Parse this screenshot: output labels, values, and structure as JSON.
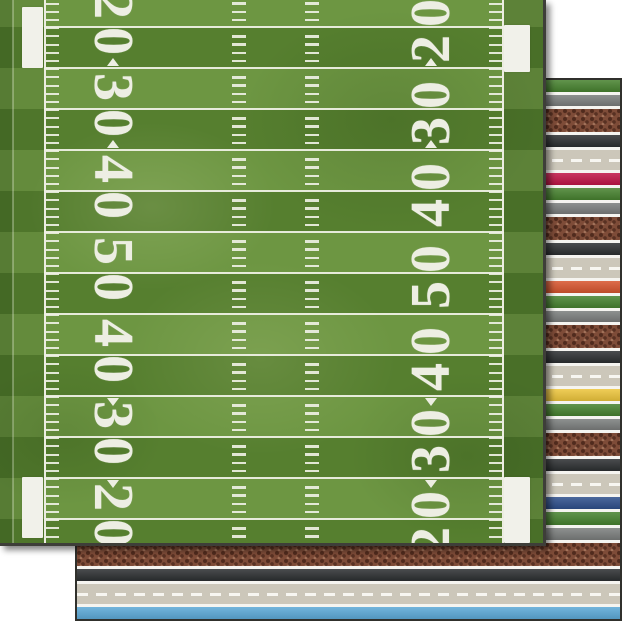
{
  "scene": {
    "background_color": "#ffffff",
    "front_sheet": "football-field",
    "back_sheet": "sport-stripes"
  },
  "field_sheet": {
    "yard_numbers": [
      {
        "value": "20",
        "arrow": "none"
      },
      {
        "value": "30",
        "arrow": "up"
      },
      {
        "value": "40",
        "arrow": "up"
      },
      {
        "value": "50",
        "arrow": "none"
      },
      {
        "value": "40",
        "arrow": "down"
      },
      {
        "value": "30",
        "arrow": "down"
      },
      {
        "value": "20",
        "arrow": "none"
      }
    ],
    "colors": {
      "band_light": "#6d9642",
      "band_dark": "#567f2f",
      "margin_green": "#48702a",
      "line_white": "#ecede1",
      "number_white": "#edeee3",
      "edge_border": "#3e3e39"
    }
  },
  "stripe_sheet": {
    "palette": {
      "green": "#47822f",
      "gray": "#7b7e7d",
      "brown": "#7e4c38",
      "black": "#2c2f31",
      "tan": "#ccc7ba",
      "crimson": "#c01546",
      "orange": "#d7552e",
      "yellow": "#edc53c",
      "navy": "#2e4f8c",
      "lightblue": "#5ba8d6",
      "white": "#f5f4f0"
    },
    "accent_cycle": [
      "crimson",
      "orange",
      "yellow",
      "navy",
      "lightblue"
    ],
    "stripes": [
      {
        "c": "green",
        "h": 12
      },
      {
        "c": "white",
        "h": 3
      },
      {
        "c": "gray",
        "h": 11
      },
      {
        "c": "white",
        "h": 3
      },
      {
        "c": "brown",
        "h": 23
      },
      {
        "c": "white",
        "h": 3
      },
      {
        "c": "black",
        "h": 12
      },
      {
        "c": "white",
        "h": 3
      },
      {
        "c": "tan",
        "h": 20
      },
      {
        "c": "white",
        "h": 3
      },
      {
        "c": "crimson",
        "h": 12
      },
      {
        "c": "white",
        "h": 3
      },
      {
        "c": "green",
        "h": 12
      },
      {
        "c": "white",
        "h": 3
      },
      {
        "c": "gray",
        "h": 11
      },
      {
        "c": "white",
        "h": 3
      },
      {
        "c": "brown",
        "h": 23
      },
      {
        "c": "white",
        "h": 3
      },
      {
        "c": "black",
        "h": 12
      },
      {
        "c": "white",
        "h": 3
      },
      {
        "c": "tan",
        "h": 20
      },
      {
        "c": "white",
        "h": 3
      },
      {
        "c": "orange",
        "h": 12
      },
      {
        "c": "white",
        "h": 3
      },
      {
        "c": "green",
        "h": 12
      },
      {
        "c": "white",
        "h": 3
      },
      {
        "c": "gray",
        "h": 11
      },
      {
        "c": "white",
        "h": 3
      },
      {
        "c": "brown",
        "h": 23
      },
      {
        "c": "white",
        "h": 3
      },
      {
        "c": "black",
        "h": 12
      },
      {
        "c": "white",
        "h": 3
      },
      {
        "c": "tan",
        "h": 20
      },
      {
        "c": "white",
        "h": 3
      },
      {
        "c": "yellow",
        "h": 12
      },
      {
        "c": "white",
        "h": 3
      },
      {
        "c": "green",
        "h": 12
      },
      {
        "c": "white",
        "h": 3
      },
      {
        "c": "gray",
        "h": 11
      },
      {
        "c": "white",
        "h": 3
      },
      {
        "c": "brown",
        "h": 23
      },
      {
        "c": "white",
        "h": 3
      },
      {
        "c": "black",
        "h": 12
      },
      {
        "c": "white",
        "h": 3
      },
      {
        "c": "tan",
        "h": 20
      },
      {
        "c": "white",
        "h": 3
      },
      {
        "c": "navy",
        "h": 12
      },
      {
        "c": "white",
        "h": 3
      },
      {
        "c": "green",
        "h": 13
      },
      {
        "c": "white",
        "h": 3
      },
      {
        "c": "gray",
        "h": 12
      },
      {
        "c": "white",
        "h": 3
      },
      {
        "c": "brown",
        "h": 23
      },
      {
        "c": "white",
        "h": 3
      },
      {
        "c": "black",
        "h": 12
      },
      {
        "c": "white",
        "h": 3
      },
      {
        "c": "tan",
        "h": 20
      },
      {
        "c": "white",
        "h": 3
      },
      {
        "c": "lightblue",
        "h": 13
      },
      {
        "c": "white",
        "h": 0,
        "fill": true
      }
    ]
  }
}
